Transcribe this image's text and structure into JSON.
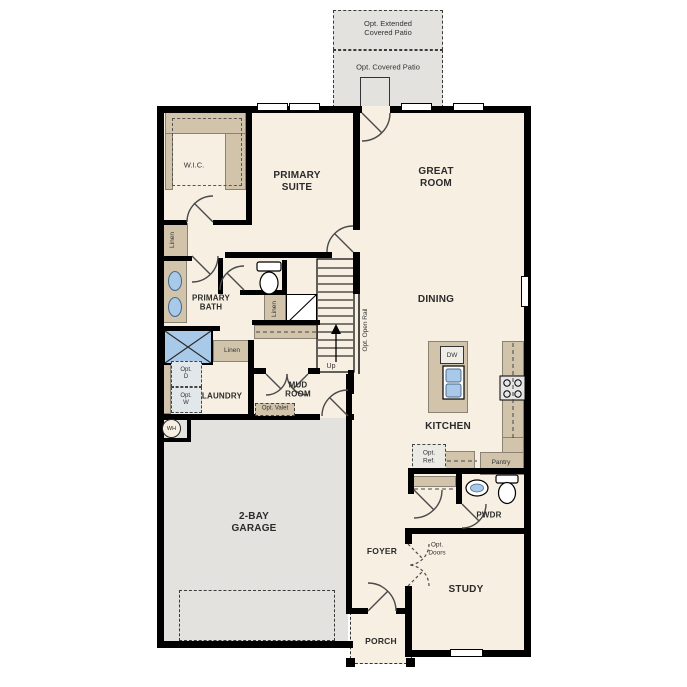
{
  "floor_plan": {
    "patios": {
      "extended": "Opt. Extended\nCovered Patio",
      "covered": "Opt. Covered Patio"
    },
    "rooms": {
      "wic": "W.I.C.",
      "primary_suite": "PRIMARY\nSUITE",
      "great_room": "GREAT\nROOM",
      "primary_bath": "PRIMARY\nBATH",
      "dining": "DINING",
      "kitchen": "KITCHEN",
      "laundry": "LAUNDRY",
      "mud_room": "MUD\nROOM",
      "garage": "2-BAY\nGARAGE",
      "foyer": "FOYER",
      "study": "STUDY",
      "pwdr": "PWDR",
      "porch": "PORCH"
    },
    "closets": {
      "linen_hall": "Linen",
      "linen_stairs": "Linen",
      "linen_bath": "Linen",
      "pantry": "Pantry"
    },
    "stairs": {
      "up": "Up",
      "opt_open_rail": "Opt. Open Rail"
    },
    "options": {
      "opt_d": "Opt.\nD",
      "opt_w": "Opt.\nW",
      "opt_valet": "Opt. Valet",
      "opt_ref": "Opt.\nRef.",
      "opt_doors": "Opt.\nDoors"
    },
    "appliances": {
      "dw": "DW",
      "wh": "WH"
    },
    "colors": {
      "wall": "#000000",
      "interior_floor": "#f6efe2",
      "garage_floor": "#e3e2de",
      "patio": "#e3e2de",
      "cabinetry": "#d2c4ab",
      "plumbing_fixture": "#a9c9e8",
      "appliance": "#e2e7ea"
    }
  }
}
